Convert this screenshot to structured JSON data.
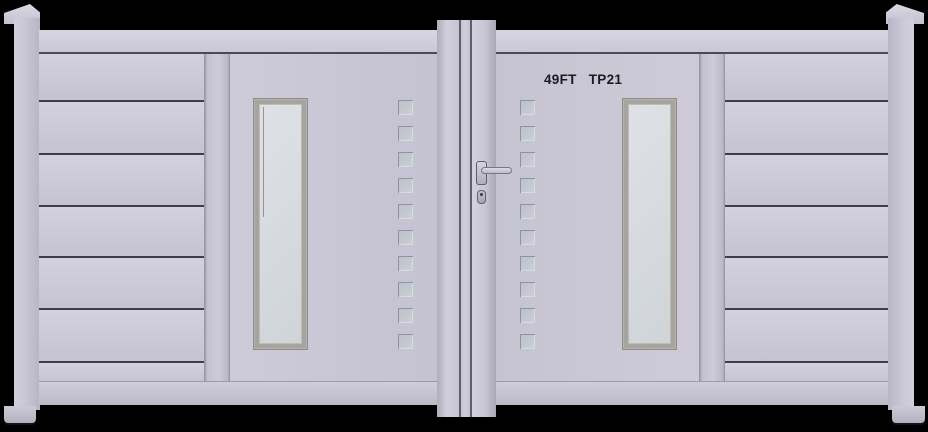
{
  "scene": {
    "description": "3D product render of an aluminium double swing driveway gate on a black background",
    "background_color": "#000000"
  },
  "gate_label": {
    "size": "49FT",
    "model": "TP21"
  },
  "colors": {
    "body": "#c9c6d4",
    "body_highlight": "#d4d1de",
    "body_shadow": "#b7b4c3",
    "slat_gap_line": "#3d3d4b",
    "window_frame": "#a7a39e",
    "frosted_glass": "#d6dade",
    "square_fill": "#c6cbd2",
    "label_text": "#1a1a1f",
    "handle_metal": "#c4c3d0",
    "background": "#000000"
  },
  "gate": {
    "leaves": 2,
    "posts": 2,
    "windows_per_leaf": 1,
    "slat_band_bounds_y": [
      52,
      100,
      153,
      205,
      256,
      308,
      361,
      382
    ],
    "square_columns_x": [
      398,
      520
    ],
    "squares_per_column": 10,
    "square_first_y": 100,
    "square_pitch_y": 26,
    "square_size": 15
  }
}
